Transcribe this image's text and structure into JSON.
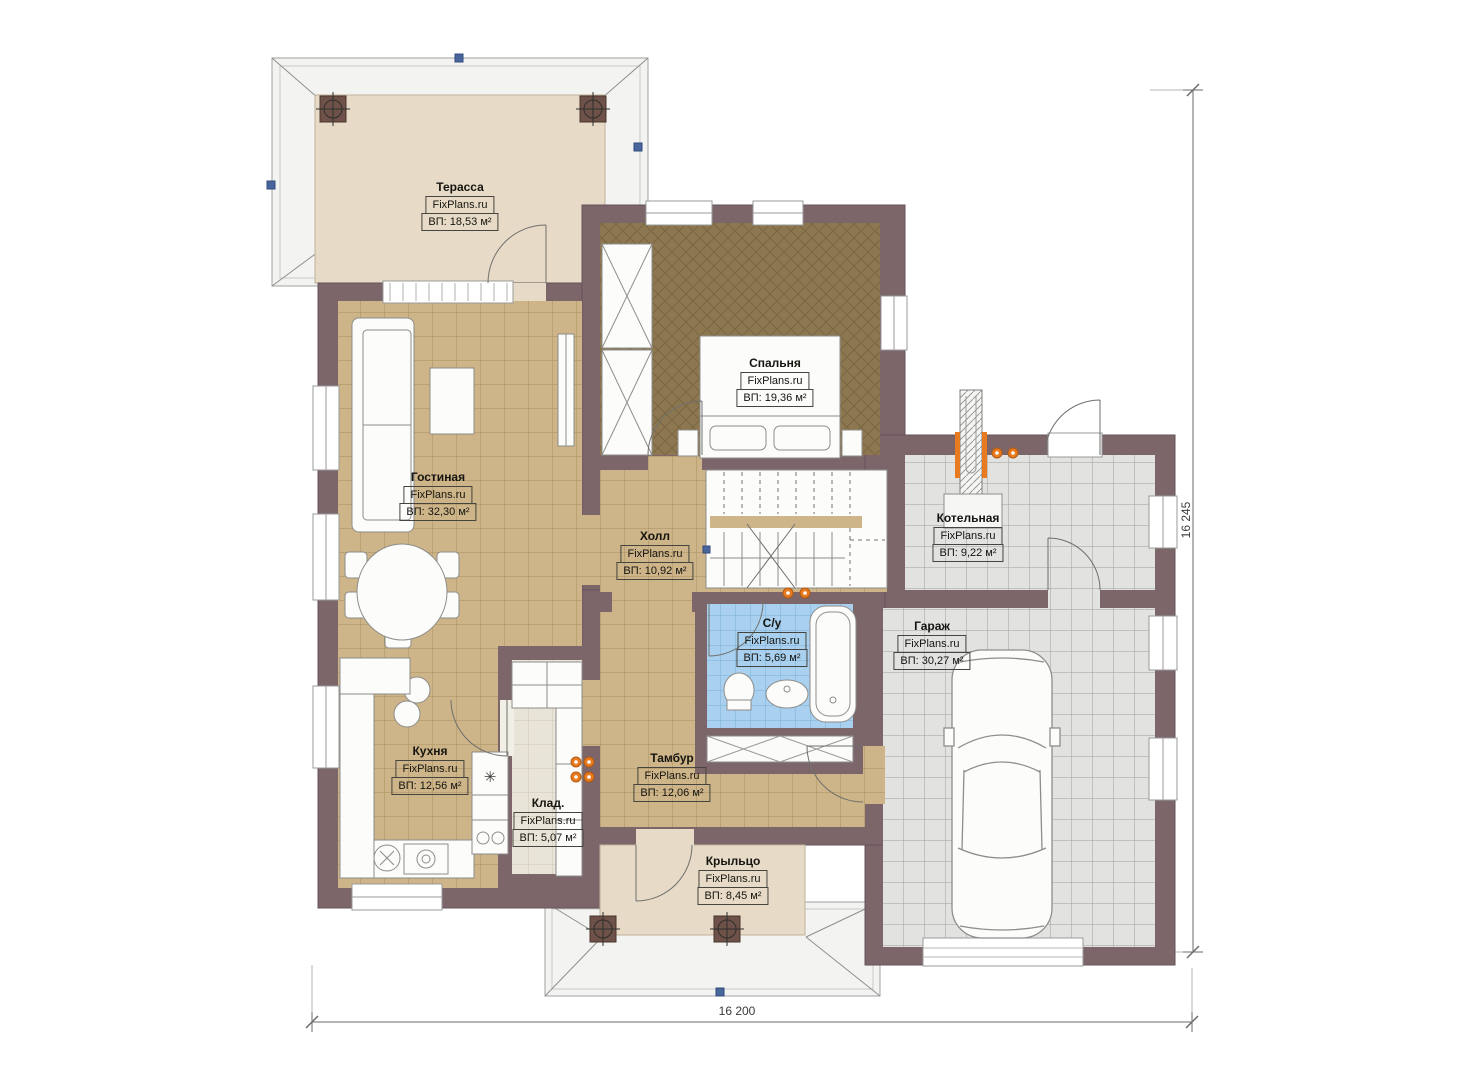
{
  "brand": "FixPlans.ru",
  "rooms": [
    {
      "id": "terrace",
      "name": "Терасса",
      "brand": "FixPlans.ru",
      "area": "ВП: 18,53 м²"
    },
    {
      "id": "bedroom",
      "name": "Спальня",
      "brand": "FixPlans.ru",
      "area": "ВП: 19,36 м²"
    },
    {
      "id": "living",
      "name": "Гостиная",
      "brand": "FixPlans.ru",
      "area": "ВП: 32,30 м²"
    },
    {
      "id": "hall",
      "name": "Холл",
      "brand": "FixPlans.ru",
      "area": "ВП: 10,92 м²"
    },
    {
      "id": "boiler",
      "name": "Котельная",
      "brand": "FixPlans.ru",
      "area": "ВП: 9,22 м²"
    },
    {
      "id": "garage",
      "name": "Гараж",
      "brand": "FixPlans.ru",
      "area": "ВП: 30,27 м²"
    },
    {
      "id": "bathroom",
      "name": "С/у",
      "brand": "FixPlans.ru",
      "area": "ВП: 5,69 м²"
    },
    {
      "id": "kitchen",
      "name": "Кухня",
      "brand": "FixPlans.ru",
      "area": "ВП: 12,56 м²"
    },
    {
      "id": "storage",
      "name": "Клад.",
      "brand": "FixPlans.ru",
      "area": "ВП: 5,07 м²"
    },
    {
      "id": "vestibule",
      "name": "Тамбур",
      "brand": "FixPlans.ru",
      "area": "ВП: 12,06 м²"
    },
    {
      "id": "porch",
      "name": "Крыльцо",
      "brand": "FixPlans.ru",
      "area": "ВП: 8,45 м²"
    }
  ],
  "dimensions": {
    "width_label": "16 200",
    "height_label": "16 245"
  },
  "symbols": {
    "fridge_icon": "✳"
  },
  "colors": {
    "wall": "#7c666a",
    "floor_tile_tan": "#cdb489",
    "floor_bedroom": "#8c7750",
    "floor_concrete": "#e2e2e0",
    "floor_bath_blue": "#a9d0ee",
    "floor_terrace": "#e7dbc7",
    "riser_orange": "#e87a20",
    "marker_blue": "#48659c",
    "roof_fill": "#f3f3f1"
  }
}
